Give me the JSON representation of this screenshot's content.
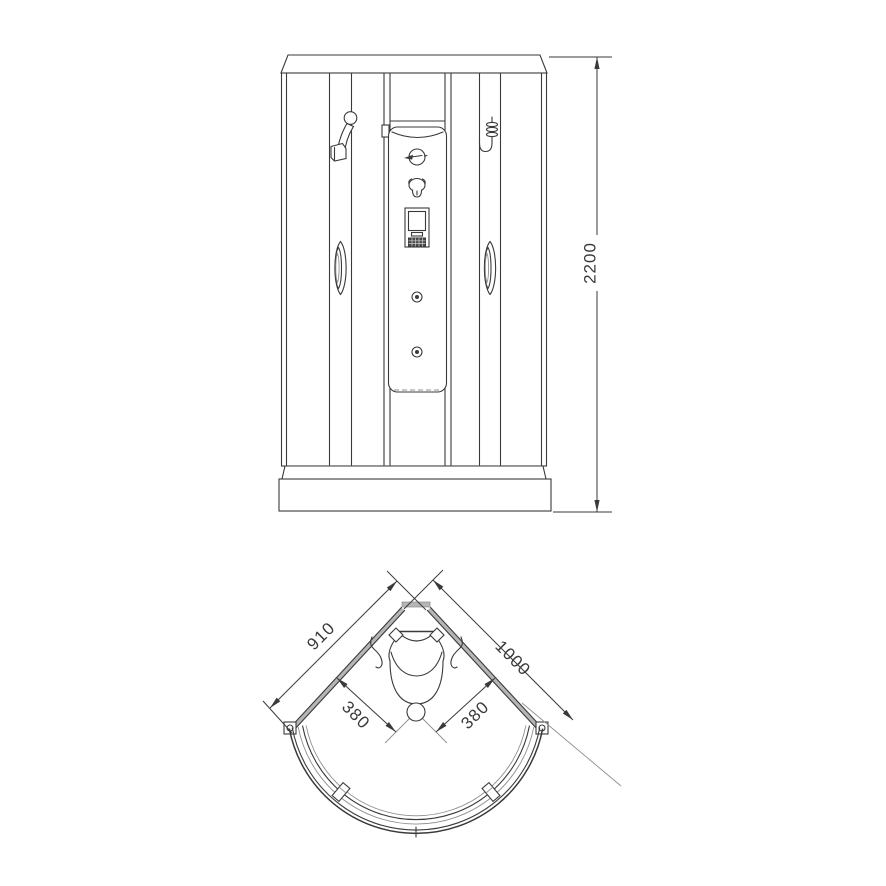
{
  "colors": {
    "line": "#3a3a3a",
    "thin": "#8f8f8f",
    "wall": "#b5b5b5",
    "bg": "#ffffff"
  },
  "front_view": {
    "title": "shower cabin front elevation",
    "dimensions": {
      "overall_height": "2200"
    }
  },
  "plan_view": {
    "title": "shower cabin plan (quarter-round corner)",
    "dimensions": {
      "left_wall": "910",
      "right_wall": "1000",
      "center_to_left_wall": "380",
      "center_to_right_wall": "380"
    }
  }
}
